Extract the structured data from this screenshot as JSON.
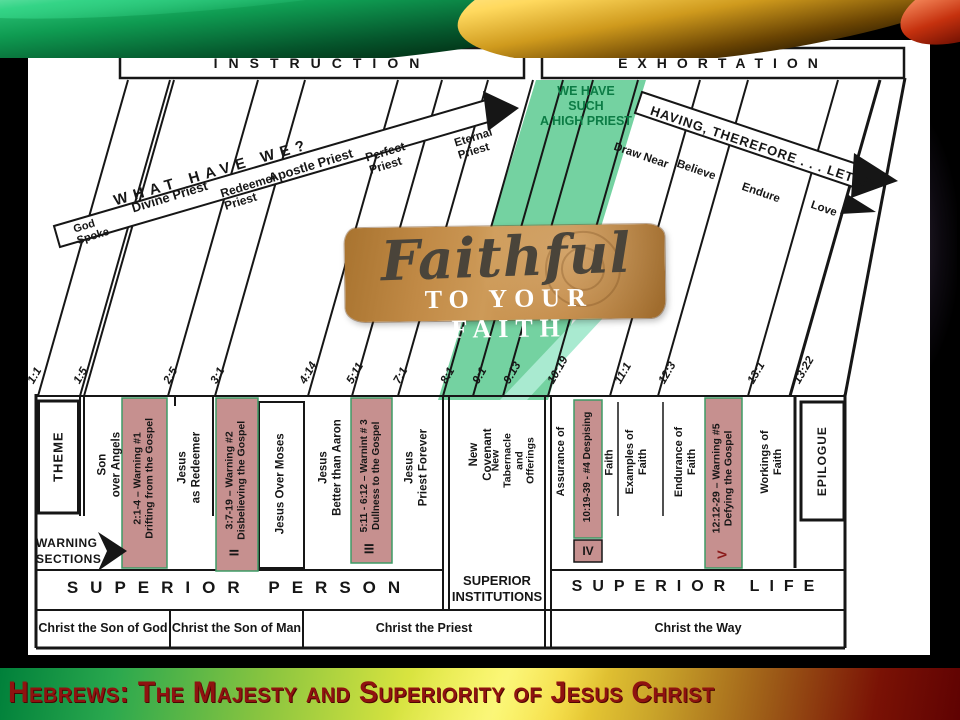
{
  "slide": {
    "headers": {
      "instruction": "INSTRUCTION",
      "exhortation": "EXHORTATION"
    },
    "left_arrow": {
      "label": "WHAT HAVE WE?"
    },
    "right_arrow": {
      "label": "HAVING, THEREFORE . . . LET US"
    },
    "highlight": {
      "label": "WE HAVE\nSUCH\nA HIGH PRIEST",
      "color": "#74d2a1"
    },
    "left_slant_labels": [
      "God\nSpoke",
      "Divine Priest",
      "Redeemer\nPriest",
      "Apostle Priest",
      "Perfect\nPriest",
      "Eternal\nPriest"
    ],
    "right_slant_labels": [
      "Draw Near",
      "Believe",
      "Endure",
      "Love"
    ],
    "refs": [
      "1:1",
      "1:5",
      "2:5",
      "3:1",
      "4:14",
      "5:11",
      "7:1",
      "8:1",
      "9:1",
      "9:13",
      "10:19",
      "11:1",
      "12:3",
      "13:1",
      "13:22"
    ],
    "columns": {
      "theme": "THEME",
      "son_over_angels": "Son\nover Angels",
      "jesus_as_redeemer": "Jesus\nas Redeemer",
      "jesus_over_moses": "Jesus Over Moses",
      "jesus_better_than_aaron": "Jesus\nBetter than Aaron",
      "jesus_priest_forever": "Jesus\nPriest Forever",
      "new_covenant": "New\nCovenant",
      "new_tabernacle": "New\nTabernacle\nand\nOfferings",
      "assurance_of": "Assurance of",
      "assurance_faith": "Faith",
      "examples_of_faith": "Examples of\nFaith",
      "endurance_of_faith": "Endurance of\nFaith",
      "workings_of_faith": "Workings of\nFaith",
      "epilogue": "EPILOGUE"
    },
    "warnings": [
      {
        "label": "2:1-4 – Warning #1\nDrifting from the Gospel"
      },
      {
        "label": "3:7-19 – Warning #2\nDisbelieving the Gospel",
        "numeral": "II"
      },
      {
        "label": "5:11 - 6:12 – Warnint # 3\nDullness to the Gospel",
        "numeral": "III"
      },
      {
        "label": "10:19-39 - #4 Despising",
        "numeral": "IV"
      },
      {
        "label": "12:12-29 – Warning #5\nDefying the Gospel",
        "numeral": "V"
      }
    ],
    "warning_sections_label": "WARNING\nSECTIONS",
    "sections": {
      "person": "SUPERIOR PERSON",
      "institutions": "SUPERIOR\nINSTITUTIONS",
      "life": "SUPERIOR LIFE"
    },
    "bottom_row": [
      "Christ the Son of God",
      "Christ the Son of Man",
      "Christ the Priest",
      "Christ the Way"
    ],
    "logo": {
      "script": "Faithful",
      "caption": "TO YOUR FAITH"
    }
  },
  "footer": {
    "title": "Hebrews: The Majesty and Superiority of Jesus Christ"
  },
  "colors": {
    "highlight_green": "#74d2a1",
    "warning_pink": "#c6908f",
    "title_red": "#8f1310",
    "logo_tan": "#bf8544"
  }
}
